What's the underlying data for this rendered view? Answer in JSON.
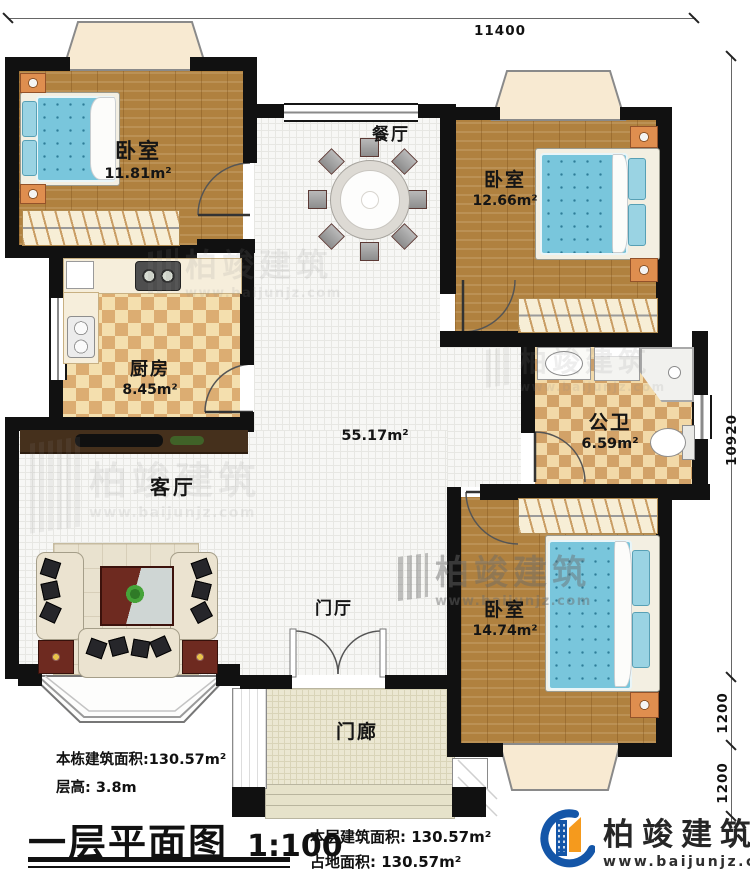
{
  "dimensions": {
    "top": "11400",
    "right_total": "10920",
    "right_seg1": "1200",
    "right_seg2": "1200"
  },
  "rooms": {
    "bedroom_top_left": {
      "name": "卧室",
      "area": "11.81m²"
    },
    "dining": {
      "name": "餐厅"
    },
    "bedroom_top_right": {
      "name": "卧室",
      "area": "12.66m²"
    },
    "kitchen": {
      "name": "厨房",
      "area": "8.45m²"
    },
    "bathroom": {
      "name": "公卫",
      "area": "6.59m²"
    },
    "living": {
      "name": "客厅",
      "open_area": "55.17m²"
    },
    "foyer": {
      "name": "门厅"
    },
    "bedroom_bottom_right": {
      "name": "卧室",
      "area": "14.74m²"
    },
    "porch": {
      "name": "门廊"
    }
  },
  "annotations": {
    "building_area": "本栋建筑面积:130.57m²",
    "floor_height": "层高: 3.8m"
  },
  "title": {
    "text": "一层平面图",
    "scale": "1:100"
  },
  "footer": {
    "floor_area": "本层建筑面积: 130.57m²",
    "ground_area": "占地面积: 130.57m²"
  },
  "brand": {
    "name": "柏竣建筑",
    "url": "www.baijunjz.com"
  },
  "watermark": {
    "name": "柏竣建筑",
    "url": "www.baijunjz.com"
  },
  "colors": {
    "wall": "#111111",
    "wood": "#b0813f",
    "tile": "#f7f7f5",
    "kitchen_checker": "#dcad72",
    "bath_checker": "#d2a268",
    "mattress": "#79c6dc",
    "brand_blue": "#1456a8",
    "brand_orange": "#f59a1d"
  }
}
